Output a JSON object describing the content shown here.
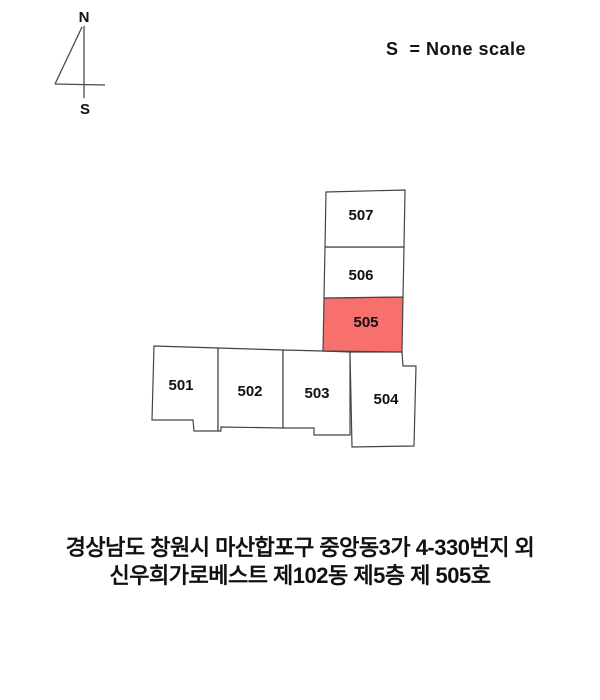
{
  "compass": {
    "north_label": "N",
    "south_label": "S"
  },
  "scale_note": "S  = None scale",
  "plan": {
    "highlight_color": "#f7706e",
    "line_color": "#444444",
    "highlighted_unit": "505",
    "units": [
      {
        "id": "501",
        "label": "501",
        "fill": "#ffffff"
      },
      {
        "id": "502",
        "label": "502",
        "fill": "#ffffff"
      },
      {
        "id": "503",
        "label": "503",
        "fill": "#ffffff"
      },
      {
        "id": "504",
        "label": "504",
        "fill": "#ffffff"
      },
      {
        "id": "505",
        "label": "505",
        "fill": "#f7706e"
      },
      {
        "id": "506",
        "label": "506",
        "fill": "#ffffff"
      },
      {
        "id": "507",
        "label": "507",
        "fill": "#ffffff"
      }
    ]
  },
  "address": {
    "line1": "경상남도 창원시 마산합포구 중앙동3가 4-330번지 외",
    "line2": "신우희가로베스트 제102동 제5층 제 505호"
  }
}
